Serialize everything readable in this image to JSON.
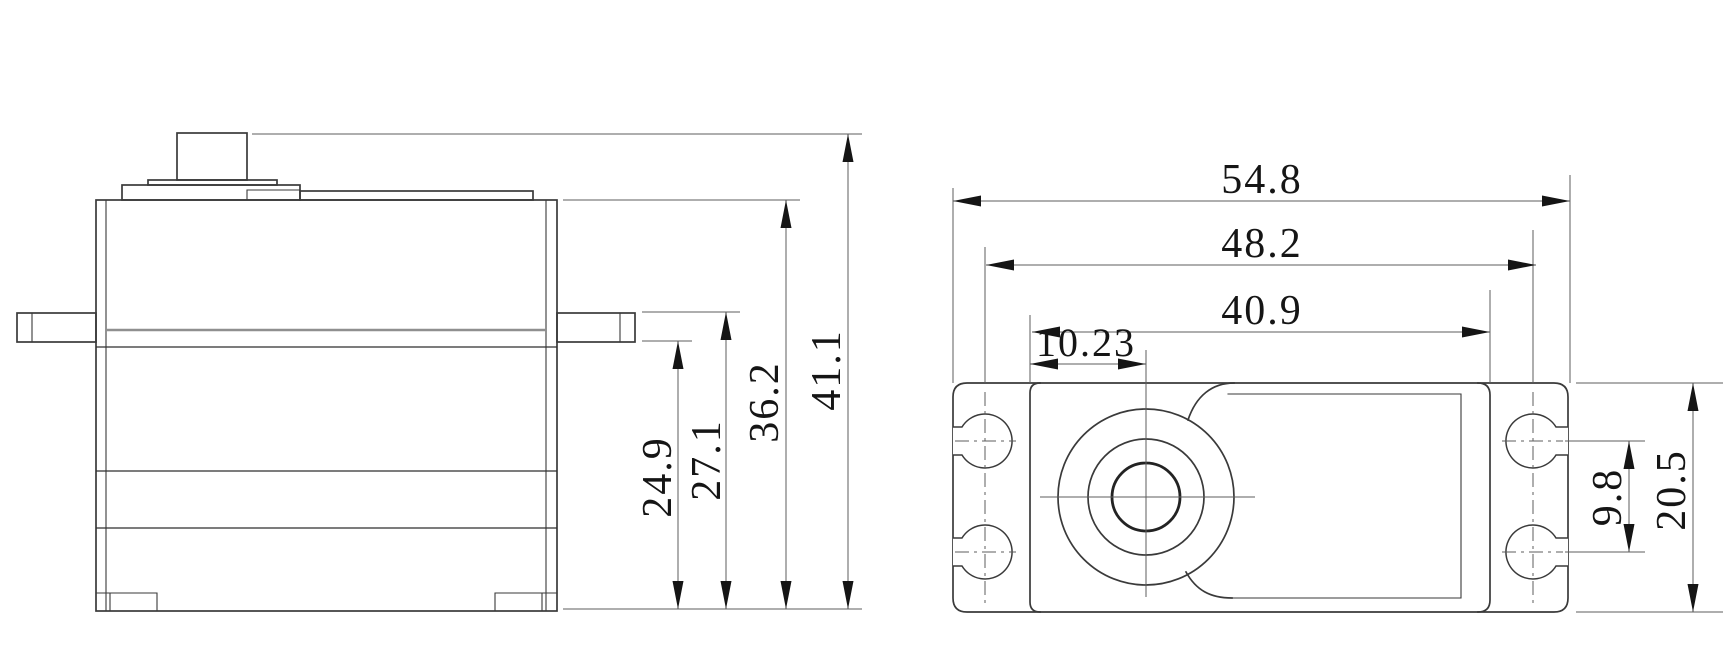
{
  "drawing": {
    "kind": "servo-dimension-drawing",
    "background": "#ffffff",
    "line_color": "#3a3a3a",
    "dim_line_color": "#5c5c5c",
    "text_color": "#151515",
    "side_view": {
      "dims": {
        "tab_bottom_to_base": "24.9",
        "tab_top_to_base": "27.1",
        "case_top_to_base": "36.2",
        "overall_height": "41.1"
      }
    },
    "top_view": {
      "dims": {
        "overall_length": "54.8",
        "mount_hole_span": "48.2",
        "case_length": "40.9",
        "shaft_center_offset": "10.23",
        "hole_pitch": "9.8",
        "overall_width": "20.5"
      }
    }
  }
}
